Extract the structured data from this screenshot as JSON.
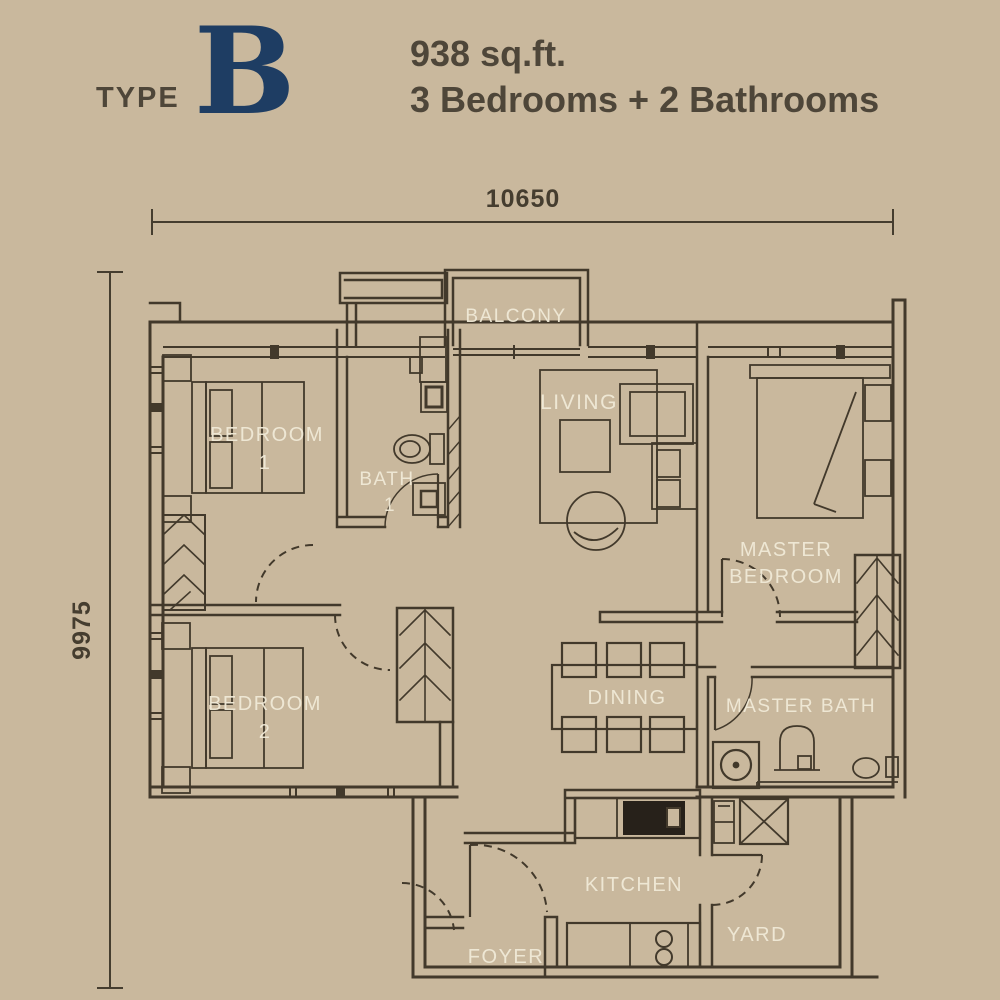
{
  "title": {
    "type_label": "TYPE",
    "type_letter": "B",
    "area": "938 sq.ft.",
    "configuration": "3 Bedrooms + 2 Bathrooms"
  },
  "dimensions": {
    "width": "10650",
    "depth": "9975"
  },
  "room_labels": {
    "balcony": "BALCONY",
    "living": "LIVING",
    "bedroom1_line1": "BEDROOM",
    "bedroom1_line2": "1",
    "bath1_line1": "BATH",
    "bath1_line2": "1",
    "master_bedroom_line1": "MASTER",
    "master_bedroom_line2": "BEDROOM",
    "bedroom2_line1": "BEDROOM",
    "bedroom2_line2": "2",
    "dining": "DINING",
    "master_bath": "MASTER BATH",
    "kitchen": "KITCHEN",
    "foyer": "FOYER",
    "yard": "YARD"
  },
  "colors": {
    "background": "#c9b89d",
    "wall": "#42392b",
    "room_label": "#f1ead7",
    "title_text": "#4e4639",
    "type_letter": "#1e3d63",
    "dimension": "#453d2f",
    "fixture_dark": "#27211a"
  }
}
